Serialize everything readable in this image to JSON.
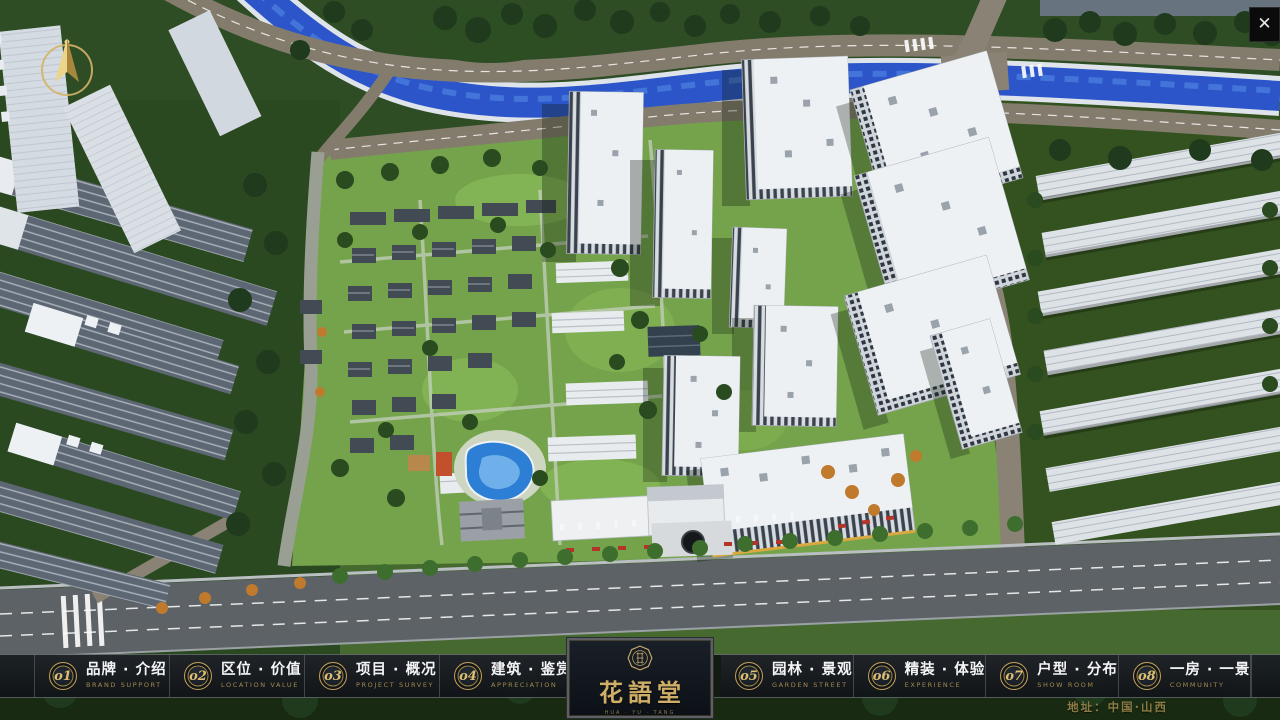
{
  "ui": {
    "close_label": "✕",
    "address": "地址：中国·山西"
  },
  "navbar": {
    "items": [
      {
        "num": "o1",
        "zh": "品牌 · 介绍",
        "en": "BRAND SUPPORT"
      },
      {
        "num": "o2",
        "zh": "区位 · 价值",
        "en": "LOCATION VALUE"
      },
      {
        "num": "o3",
        "zh": "项目 · 概况",
        "en": "PROJECT SURVEY"
      },
      {
        "num": "o4",
        "zh": "建筑 · 鉴赏",
        "en": "APPRECIATION"
      },
      {
        "num": "o5",
        "zh": "园林 · 景观",
        "en": "GARDEN STREET"
      },
      {
        "num": "o6",
        "zh": "精装 · 体验",
        "en": "EXPERIENCE"
      },
      {
        "num": "o7",
        "zh": "户型 · 分布",
        "en": "SHOW ROOM"
      },
      {
        "num": "o8",
        "zh": "一房 · 一景",
        "en": "COMMUNITY"
      }
    ]
  },
  "logo": {
    "title": "花語堂",
    "tagline": "HUA · YU · TANG"
  },
  "colors": {
    "gold_accent": "#c9a55c",
    "river_blue": "#2b55c8",
    "nav_background": "rgba(14,17,21,0.8)",
    "tree_dark_green": "#1f3a1c",
    "lawn_green": "#74a34b"
  }
}
